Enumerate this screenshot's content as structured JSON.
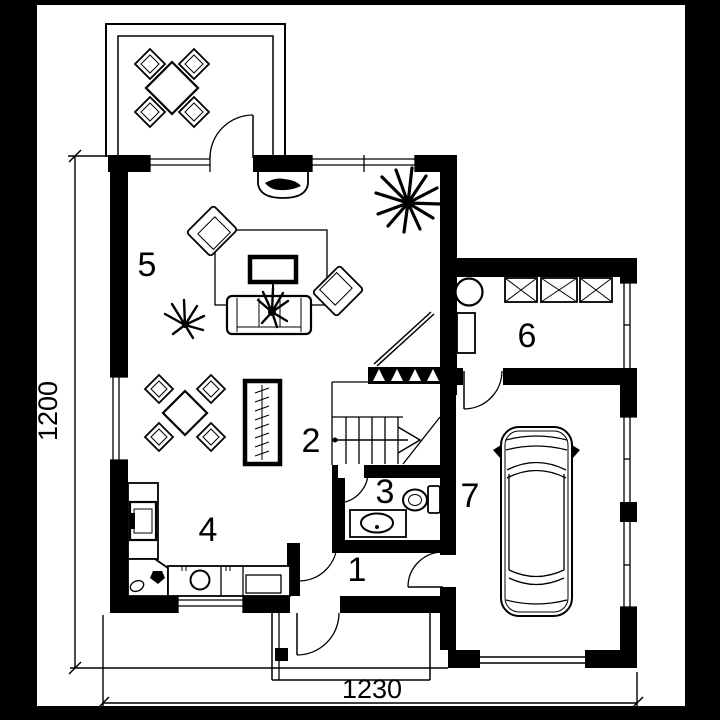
{
  "floor_plan": {
    "type": "architectural-floor-plan-ground-floor",
    "rooms": [
      {
        "label": "1"
      },
      {
        "label": "2"
      },
      {
        "label": "3"
      },
      {
        "label": "4"
      },
      {
        "label": "5"
      },
      {
        "label": "6"
      },
      {
        "label": "7"
      }
    ],
    "dimensions": {
      "height": "1200",
      "width": "1230"
    },
    "colors": {
      "ink": "#000000",
      "paper": "#ffffff",
      "background": "#000000"
    },
    "symbols": [
      "terrace-table-with-four-chairs",
      "dining-table-with-four-chairs",
      "sofa",
      "armchair",
      "coffee-table",
      "rug",
      "fireplace",
      "potted-plant",
      "radiator",
      "staircase-with-direction-arrow",
      "handrail",
      "washbasin",
      "toilet",
      "kitchen-counter",
      "kitchen-sink",
      "stove",
      "wardrobe-crossed-box",
      "boiler",
      "car-top-view",
      "door-swing",
      "window",
      "entrance-porch",
      "garage-door"
    ]
  }
}
